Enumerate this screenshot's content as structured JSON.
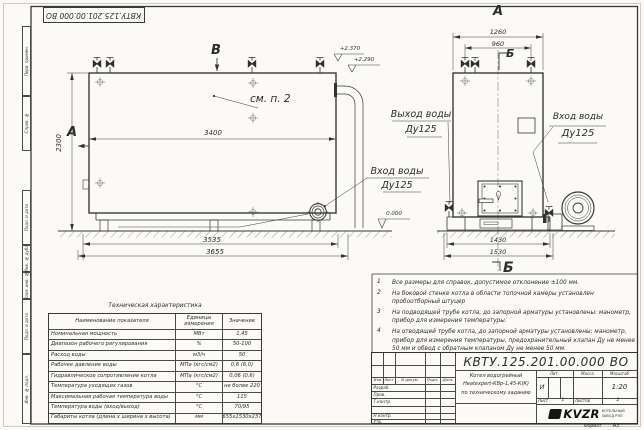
{
  "drawing": {
    "number": "КВТУ.125.201.00.000 ВО",
    "format_label": "Формат",
    "format_value": "А3",
    "line_color": "#3a3a3a",
    "paper_color": "#fbfaf6"
  },
  "frame_labels": [
    "Перв. примен.",
    "Справ. №",
    "Подп. и дата",
    "Инв. № дубл.",
    "Взам. инв. №",
    "Подп. и дата",
    "Инв. № подл."
  ],
  "main_view": {
    "marker_a": "А",
    "marker_b": "В",
    "see_note": "см. п. 2",
    "dim_length": "3400",
    "dim_height": "2300",
    "dim_base": "3535",
    "dim_overall": "3655",
    "level_top": "+2.370",
    "level_mid": "+2.290",
    "level_zero": "0.000",
    "inlet_line1": "Вход воды",
    "inlet_line2": "Ду125"
  },
  "front_view": {
    "title": "А",
    "marker_b_top": "Б",
    "marker_b_bottom": "Б",
    "dim_top_outer": "1260",
    "dim_top_inner": "960",
    "dim_bottom_inner": "1430",
    "dim_bottom_outer": "1530",
    "outlet_line1": "Выход воды",
    "outlet_line2": "Ду125",
    "inlet_line1": "Вход воды",
    "inlet_line2": "Ду125"
  },
  "notes": [
    {
      "n": "1",
      "text": "Все размеры для справок, допустимое отклонение ±100 мм."
    },
    {
      "n": "2",
      "text": "На боковой стенке котла в области топочной камеры установлен пробоотборный штуцер"
    },
    {
      "n": "3",
      "text": "На подводящей трубе котла, до запорной арматуры установлены: манометр, прибор для измерения температуры."
    },
    {
      "n": "4",
      "text": "На отводящей трубе котла, до запорной арматуры установлены: манометр, прибор для измерения температуры, предохранительный клапан Ду не менее 50 мм и обвод с обратным клапаном Ду не менее 50 мм."
    }
  ],
  "spec_table": {
    "title": "Техническая характеристика",
    "col_name": "Наименование показателя",
    "col_units": "Единицы измерения",
    "col_value": "Значение",
    "rows": [
      {
        "name": "Номинальная мощность",
        "units": "МВт",
        "value": "1,45"
      },
      {
        "name": "Диапазон рабочего регулирования",
        "units": "%",
        "value": "50-100"
      },
      {
        "name": "Расход воды",
        "units": "м3/ч",
        "value": "50"
      },
      {
        "name": "Рабочее давление воды",
        "units": "МПа (кгс/см2)",
        "value": "0,6 (6,0)"
      },
      {
        "name": "Гидравлическое сопротивление котла",
        "units": "МПа (кгс/см2)",
        "value": "0,06 (0,6)"
      },
      {
        "name": "Температура уходящих газов",
        "units": "°С",
        "value": "не более 220"
      },
      {
        "name": "Максимальная рабочая температура воды",
        "units": "°С",
        "value": "115"
      },
      {
        "name": "Температура воды (вход/выход)",
        "units": "°С",
        "value": "70/95"
      },
      {
        "name": "Габариты котла (длина х ширина х высота)",
        "units": "мм",
        "value": "3655х1530х2370"
      }
    ]
  },
  "title_block": {
    "header_izm": "Изм",
    "header_list": "Лист",
    "header_doc": "N докум.",
    "header_sign": "Подп.",
    "header_date": "Дата",
    "roles": [
      "Разраб.",
      "Пров.",
      "Т.контр.",
      "",
      "Н.контр.",
      "Утв."
    ],
    "product_line1": "Котел водогрейный",
    "product_line2": "Heatexpert-КВр-1,45-К(К)",
    "product_line3": "по техническому заданию",
    "lit_label": "Лит.",
    "lit_value": "И",
    "mass_label": "Масса",
    "scale_label": "Масштаб",
    "scale_value": "1:20",
    "sheet_label": "Лист",
    "sheet_value": "1",
    "sheets_label": "Листов",
    "sheets_value": "2",
    "logo_text": "KVZR",
    "company_line1": "КОТЕЛЬНЫЙ",
    "company_line2": "ЗАВОД РЭП"
  }
}
